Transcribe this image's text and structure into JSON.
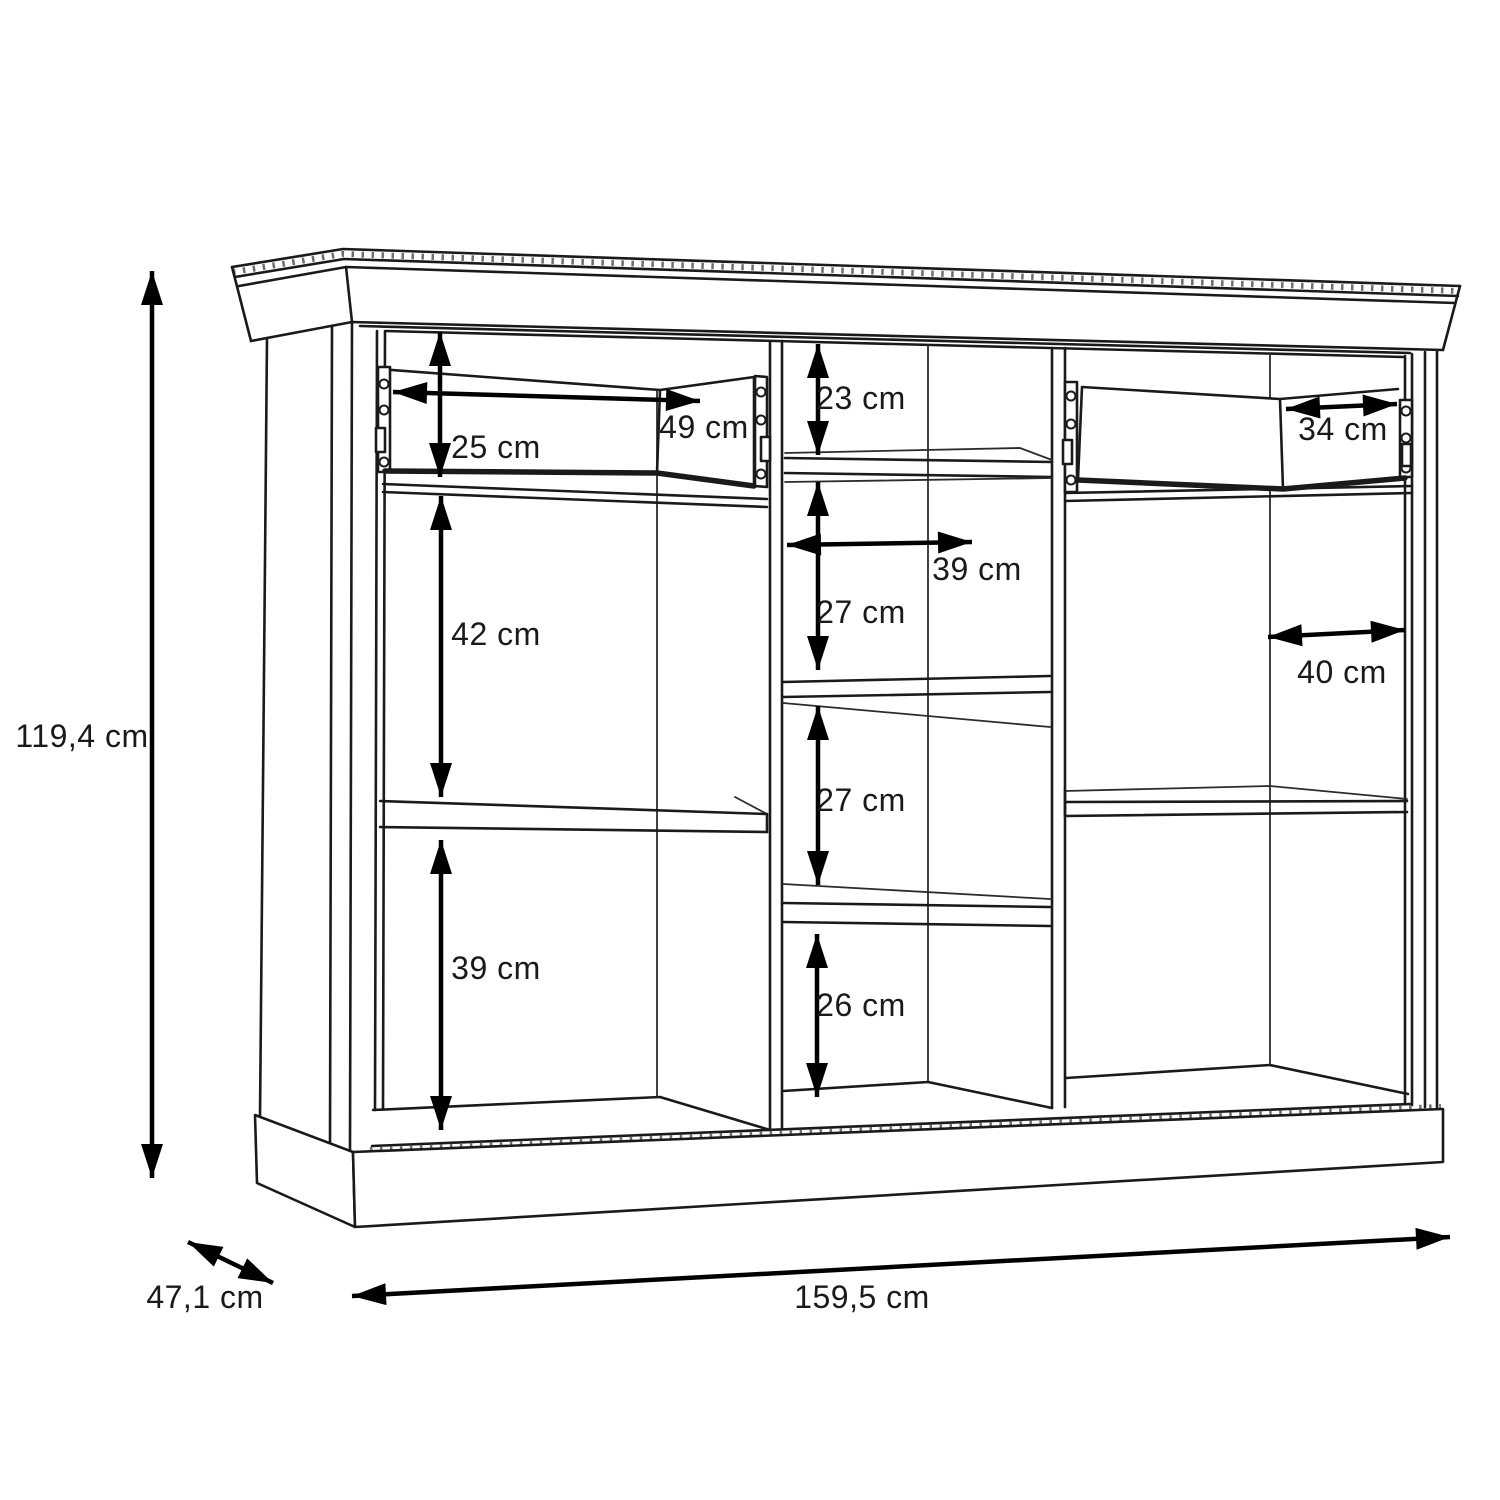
{
  "page": {
    "background": "#ffffff",
    "description": "Technical line drawing of a three-section sideboard cabinet shown in perspective with open drawers, shelves and interior dimension arrows"
  },
  "diagram": {
    "unit": "cm",
    "line_color": "#1a1a1a",
    "dimension_color": "#000000",
    "dimensions": {
      "height": "119,4 cm",
      "depth": "47,1 cm",
      "width": "159,5 cm",
      "left_drawer_height": "25 cm",
      "left_drawer_width": "49 cm",
      "left_middle_space": "42 cm",
      "left_bottom_space": "39 cm",
      "mid_top_space": "23 cm",
      "mid_width": "39 cm",
      "mid_upper_space": "27 cm",
      "mid_lower_space": "27 cm",
      "mid_bottom_space": "26 cm",
      "right_drawer_width": "34 cm",
      "right_width": "40 cm"
    }
  }
}
